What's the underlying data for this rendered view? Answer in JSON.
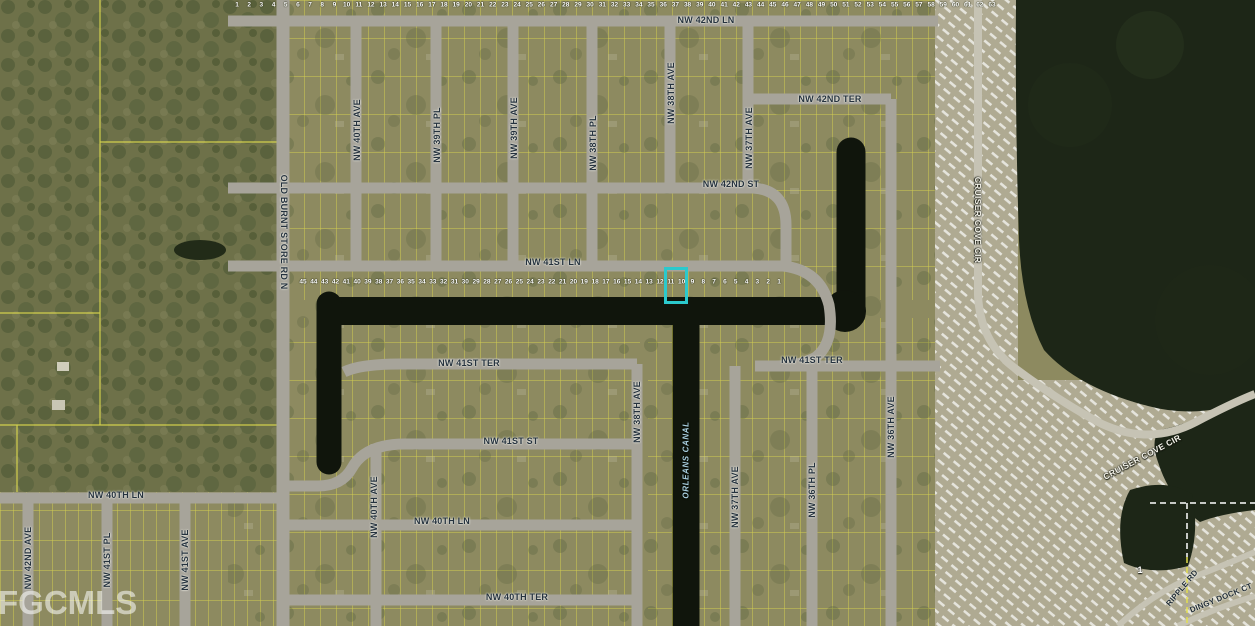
{
  "map": {
    "watermark": "FGCMLS",
    "highlight": {
      "x": 664,
      "y": 267,
      "width": 24,
      "height": 37,
      "color": "#2BC9CD"
    },
    "street_labels": [
      {
        "text": "NW 42ND LN",
        "x": 706,
        "y": 20,
        "rot": 0,
        "kind": "street"
      },
      {
        "text": "NW 42ND TER",
        "x": 830,
        "y": 99,
        "rot": 0,
        "kind": "street"
      },
      {
        "text": "NW 42ND ST",
        "x": 731,
        "y": 184,
        "rot": 0,
        "kind": "street"
      },
      {
        "text": "NW 41ST LN",
        "x": 553,
        "y": 262,
        "rot": 0,
        "kind": "street"
      },
      {
        "text": "NW 41ST TER",
        "x": 469,
        "y": 363,
        "rot": 0,
        "kind": "street"
      },
      {
        "text": "NW 41ST TER",
        "x": 812,
        "y": 360,
        "rot": 0,
        "kind": "street"
      },
      {
        "text": "NW 41ST ST",
        "x": 511,
        "y": 441,
        "rot": 0,
        "kind": "street"
      },
      {
        "text": "NW 40TH LN",
        "x": 116,
        "y": 495,
        "rot": 0,
        "kind": "street"
      },
      {
        "text": "NW 40TH LN",
        "x": 442,
        "y": 521,
        "rot": 0,
        "kind": "street"
      },
      {
        "text": "NW 40TH TER",
        "x": 517,
        "y": 597,
        "rot": 0,
        "kind": "street"
      },
      {
        "text": "OLD BURNT STORE RD N",
        "x": 284,
        "y": 232,
        "rot": 90,
        "kind": "street"
      },
      {
        "text": "NW 40TH AVE",
        "x": 357,
        "y": 130,
        "rot": -90,
        "kind": "street"
      },
      {
        "text": "NW 39TH PL",
        "x": 437,
        "y": 135,
        "rot": -90,
        "kind": "street"
      },
      {
        "text": "NW 39TH AVE",
        "x": 514,
        "y": 128,
        "rot": -90,
        "kind": "street"
      },
      {
        "text": "NW 38TH PL",
        "x": 593,
        "y": 143,
        "rot": -90,
        "kind": "street"
      },
      {
        "text": "NW 38TH AVE",
        "x": 671,
        "y": 93,
        "rot": -90,
        "kind": "street"
      },
      {
        "text": "NW 37TH AVE",
        "x": 749,
        "y": 138,
        "rot": -90,
        "kind": "street"
      },
      {
        "text": "NW 38TH AVE",
        "x": 637,
        "y": 412,
        "rot": -90,
        "kind": "street"
      },
      {
        "text": "NW 37TH AVE",
        "x": 735,
        "y": 497,
        "rot": -90,
        "kind": "street"
      },
      {
        "text": "NW 36TH PL",
        "x": 812,
        "y": 490,
        "rot": -90,
        "kind": "street"
      },
      {
        "text": "NW 36TH AVE",
        "x": 891,
        "y": 427,
        "rot": -90,
        "kind": "street"
      },
      {
        "text": "NW 42ND AVE",
        "x": 28,
        "y": 558,
        "rot": -90,
        "kind": "street"
      },
      {
        "text": "NW 41ST PL",
        "x": 107,
        "y": 560,
        "rot": -90,
        "kind": "street"
      },
      {
        "text": "NW 41ST AVE",
        "x": 185,
        "y": 560,
        "rot": -90,
        "kind": "street"
      },
      {
        "text": "NW 40TH AVE",
        "x": 374,
        "y": 507,
        "rot": -90,
        "kind": "street"
      },
      {
        "text": "CRUISER COVE CIR",
        "x": 978,
        "y": 220,
        "rot": 90,
        "kind": "park"
      },
      {
        "text": "CRUISER COVE CIR",
        "x": 1142,
        "y": 457,
        "rot": -28,
        "kind": "park"
      },
      {
        "text": "RIPPLE RD",
        "x": 1182,
        "y": 588,
        "rot": -50,
        "kind": "street-sm"
      },
      {
        "text": "DINGY DOCK CT",
        "x": 1221,
        "y": 598,
        "rot": -22,
        "kind": "street-sm"
      },
      {
        "text": "ORLEANS CANAL",
        "x": 686,
        "y": 460,
        "rot": -90,
        "kind": "water"
      },
      {
        "text": "1",
        "x": 1140,
        "y": 570,
        "rot": 0,
        "kind": "lot"
      }
    ],
    "lot_number_rows": [
      {
        "name": "top-edge-lot-numbers",
        "y": 5,
        "x_start": 237,
        "x_end": 992,
        "from": 1,
        "to": 63
      },
      {
        "name": "canal-front-lot-numbers",
        "y": 282,
        "x_start": 303,
        "x_end": 779,
        "from": 45,
        "to": 1
      }
    ],
    "colors": {
      "residential_base": "#8D8A60",
      "woods": "#6E7149",
      "water": "#1D2617",
      "canal": "#10150C",
      "road": "#A7A49A",
      "park_road": "#C6C3B4",
      "parcel_line": "#E3DF4E",
      "park_base": "#AFAA92",
      "street_label": "#25323E",
      "lot_number": "#FFFFFF",
      "water_label": "#A9CFE0",
      "highlight": "#2BC9CD",
      "watermark_color": "#FFFFFF"
    }
  }
}
